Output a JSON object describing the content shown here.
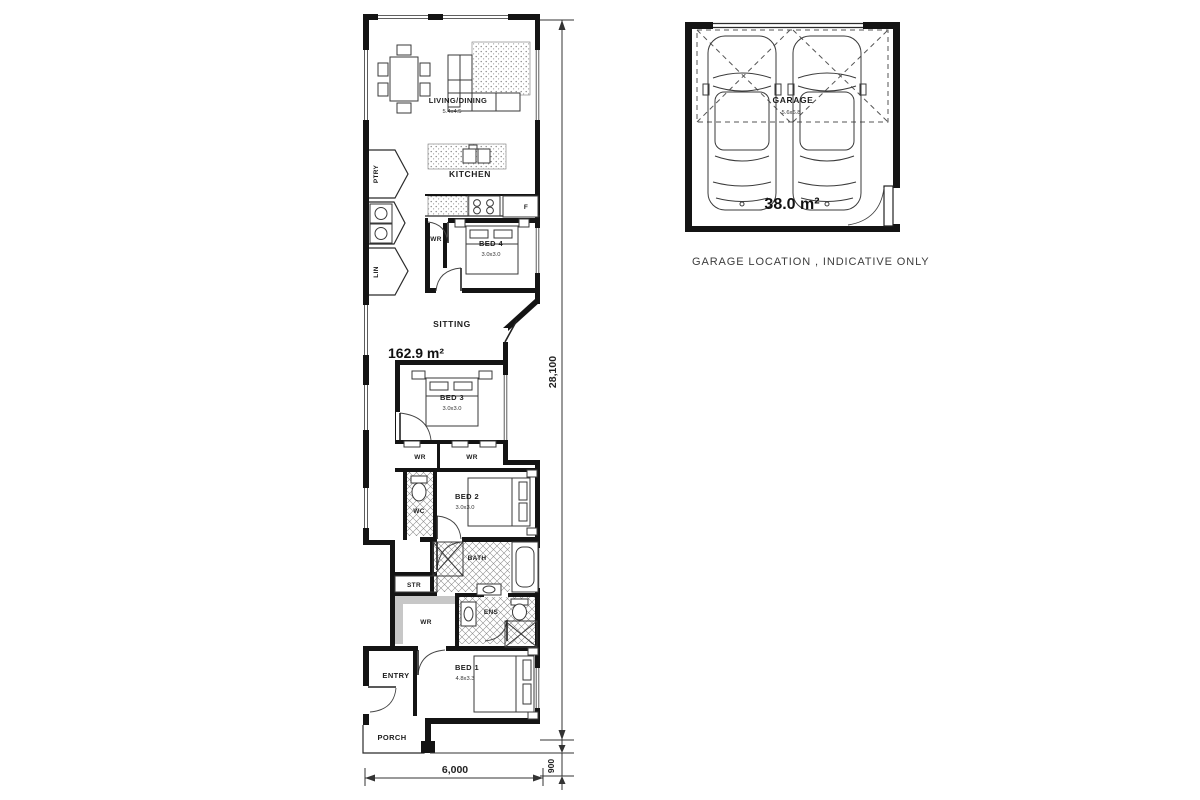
{
  "floorplan": {
    "total_area": "162.9 m²",
    "rooms": {
      "living_dining": {
        "label": "LIVING/DINING",
        "dims": "5.4x4.5"
      },
      "kitchen": {
        "label": "KITCHEN"
      },
      "pantry": {
        "label": "PTRY"
      },
      "linen": {
        "label": "LIN"
      },
      "fridge": {
        "label": "F"
      },
      "bed4": {
        "label": "BED 4",
        "dims": "3.0x3.0"
      },
      "bed4_robe": {
        "label": "WR"
      },
      "sitting": {
        "label": "SITTING"
      },
      "bed3": {
        "label": "BED 3",
        "dims": "3.0x3.0"
      },
      "bed3_robe": {
        "label": "WR"
      },
      "bed2_robe": {
        "label": "WR"
      },
      "wc": {
        "label": "WC"
      },
      "bed2": {
        "label": "BED 2",
        "dims": "3.0x3.0"
      },
      "bath": {
        "label": "BATH"
      },
      "store": {
        "label": "STR"
      },
      "bed1_robe": {
        "label": "WR"
      },
      "ensuite": {
        "label": "ENS"
      },
      "bed1": {
        "label": "BED 1",
        "dims": "4.8x3.3"
      },
      "entry": {
        "label": "ENTRY"
      },
      "porch": {
        "label": "PORCH"
      }
    },
    "dimensions": {
      "overall_length": "28,100",
      "overall_width": "6,000",
      "porch_depth": "900"
    }
  },
  "garage": {
    "label": "GARAGE",
    "dims": "5.6x6.8",
    "area": "38.0 m²",
    "note": "GARAGE LOCATION , INDICATIVE ONLY"
  }
}
